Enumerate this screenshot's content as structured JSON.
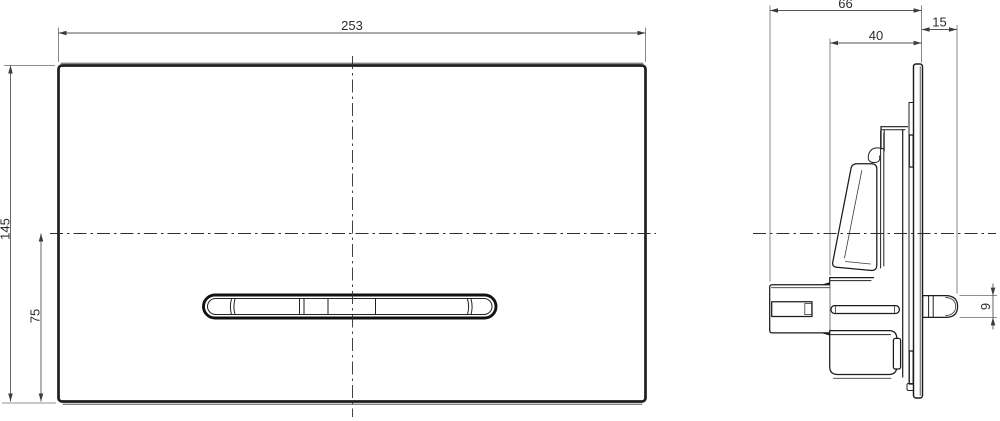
{
  "colors": {
    "background": "#ffffff",
    "outline": "#1b1b1b",
    "dimension_lines": "#555555",
    "text": "#2c2c2c"
  },
  "dims": {
    "front": {
      "width": "253",
      "height": "145",
      "axis_from_bottom": "75"
    },
    "side": {
      "total_depth": "66",
      "housing_depth": "40",
      "plate_protrusion": "15",
      "pin_height": "9"
    }
  }
}
